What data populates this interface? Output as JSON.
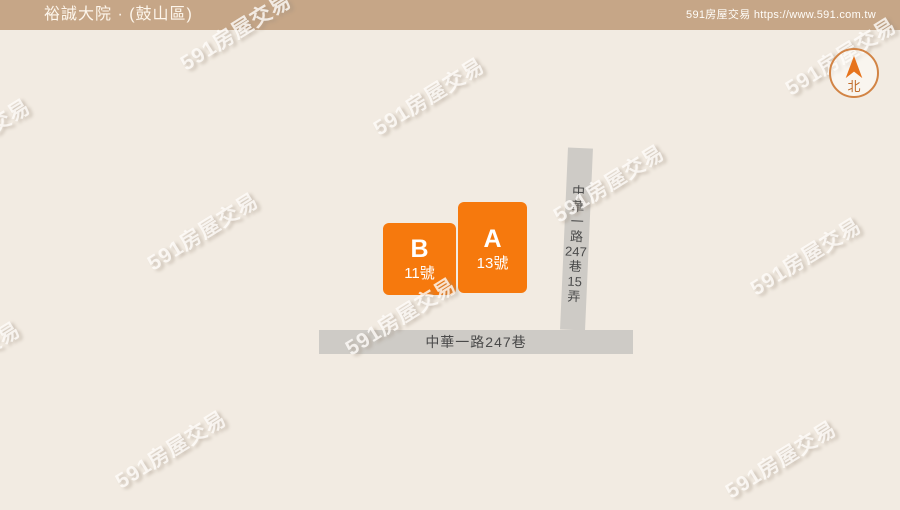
{
  "header": {
    "title": "裕誠大院 · (鼓山區)",
    "site_credit": "591房屋交易 https://www.591.com.tw"
  },
  "compass": {
    "north_label": "北"
  },
  "map": {
    "buildings": [
      {
        "label": "B",
        "house_number": "11號"
      },
      {
        "label": "A",
        "house_number": "13號"
      }
    ],
    "roads": {
      "horizontal": {
        "name": "中華一路247巷"
      },
      "vertical": {
        "name": "中華一路247巷15弄",
        "segments": [
          "中",
          "華",
          "一",
          "路",
          "247",
          "巷",
          "15",
          "弄"
        ]
      }
    }
  },
  "watermark": {
    "text": "591房屋交易"
  },
  "colors": {
    "header_bg": "#c6a687",
    "background": "#f2ebe2",
    "building_orange": "#f6790d",
    "road_gray": "#cecbc6",
    "road_text": "#4a4a4a",
    "compass_orange": "#e6731c"
  }
}
